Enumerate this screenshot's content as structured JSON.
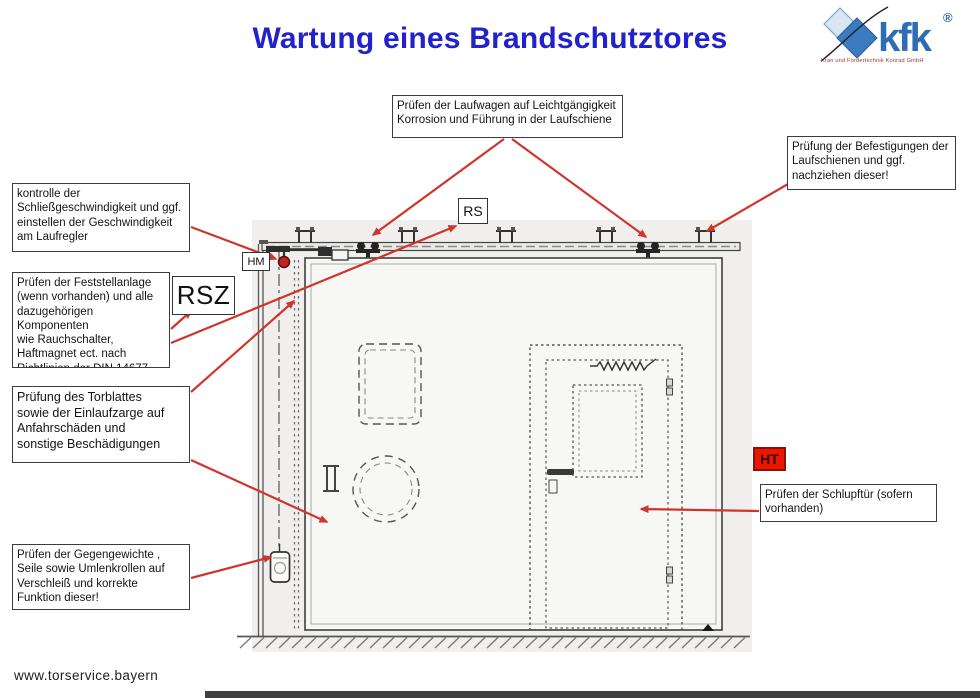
{
  "title": "Wartung eines Brandschutztores",
  "logo": {
    "brand": "kfk",
    "registered": "®",
    "caption": "Kran und Fördertechnik Konrad GmbH"
  },
  "tags": {
    "rs": "RS",
    "hm": "HM",
    "rsz": "RSZ",
    "ht": "HT"
  },
  "callouts": {
    "laufwagen": {
      "lines": [
        "Prüfen der Laufwagen auf Leichtgängigkeit",
        "Korrosion  und Führung in der Laufschiene"
      ]
    },
    "befestigung": {
      "lines": [
        "Prüfung der Befestigungen der",
        "Laufschienen und ggf.",
        "nachziehen dieser!"
      ]
    },
    "schliessgeschw": {
      "lines": [
        "kontrolle der",
        "Schließgeschwindigkeit und ggf.",
        "einstellen der Geschwindigkeit",
        "am Laufregler"
      ]
    },
    "feststellanlage": {
      "lines": [
        "Prüfen der Feststellanlage",
        "(wenn vorhanden) und alle",
        "dazugehörigen Komponenten",
        "wie Rauchschalter,",
        "Haftmagnet ect. nach",
        "Richtlinien der DIN 14677"
      ]
    },
    "torblatt": {
      "lines": [
        "Prüfung des Torblattes",
        "sowie der Einlaufzarge auf",
        "Anfahrschäden und",
        "sonstige Beschädigungen"
      ]
    },
    "gegengewichte": {
      "lines": [
        "Prüfen der Gegengewichte ,",
        "Seile sowie Umlenkrollen auf",
        "Verschleiß und korrekte",
        "Funktion dieser!"
      ]
    },
    "schlupftuer": {
      "lines": [
        "Prüfen der Schlupftür (sofern",
        "vorhanden)"
      ]
    }
  },
  "footer": {
    "website": "www.torservice.bayern"
  },
  "colors": {
    "title_blue": "#2222cc",
    "arrow_red": "#cf352b",
    "ht_red": "#ee1500",
    "logo_blue": "#2e6cb3",
    "line_gray": "#4a4a4a"
  }
}
